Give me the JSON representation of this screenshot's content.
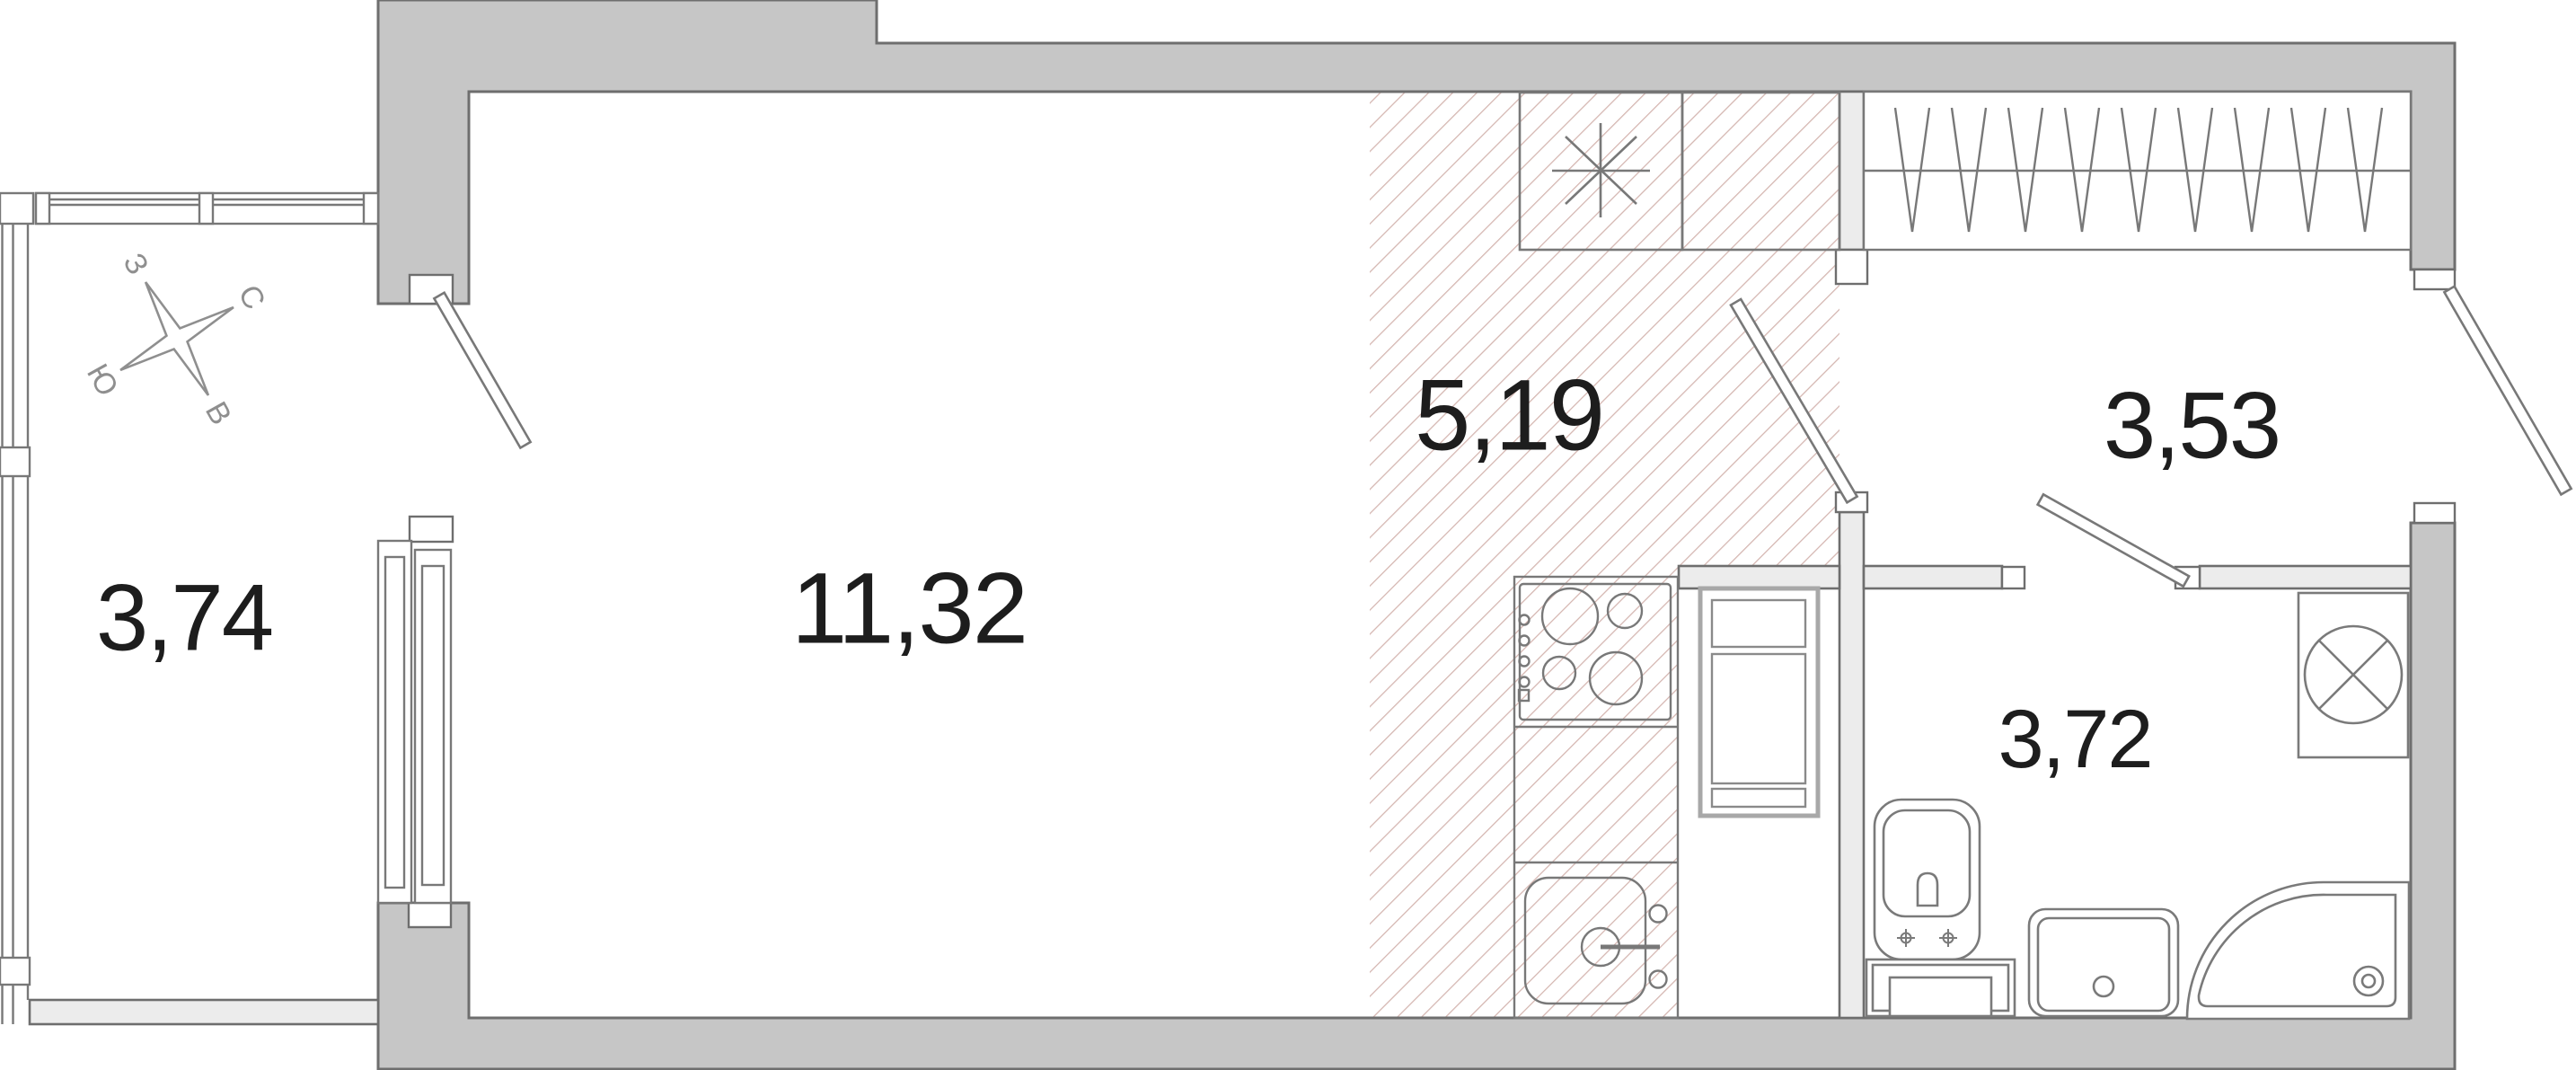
{
  "plan": {
    "kind": "studio apartment floor plan",
    "rooms": [
      {
        "id": "living-room",
        "area": "11,32"
      },
      {
        "id": "kitchen",
        "area": "5,19"
      },
      {
        "id": "hallway",
        "area": "3,53"
      },
      {
        "id": "bathroom",
        "area": "3,72"
      },
      {
        "id": "balcony",
        "area": "3,74"
      }
    ],
    "compass": {
      "north": "С",
      "east": "В",
      "south": "Ю",
      "west": "З"
    },
    "colors": {
      "background": "#ffffff",
      "wall_fill": "#c6c6c6",
      "wall_stroke": "#6e6e6e",
      "partition_fill": "#ececec",
      "fixture_stroke": "#7a7a7a",
      "hatch_line": "#d4b5b0",
      "label_text": "#1d1d1d",
      "compass_stroke": "#8f8f8f"
    }
  }
}
